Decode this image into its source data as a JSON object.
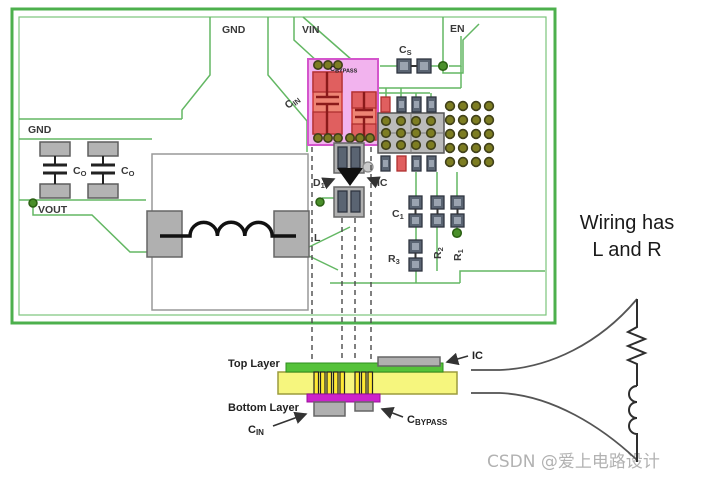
{
  "diagram": {
    "net_labels": {
      "gnd_top": {
        "main": "GND",
        "sub": ""
      },
      "vin": {
        "main": "VIN",
        "sub": ""
      },
      "en": {
        "main": "EN",
        "sub": ""
      },
      "gnd_left": {
        "main": "GND",
        "sub": ""
      },
      "vout": {
        "main": "VOUT",
        "sub": ""
      }
    },
    "components": {
      "cs": {
        "main": "C",
        "sub": "S"
      },
      "cin": {
        "main": "C",
        "sub": "IN"
      },
      "cbypass": {
        "main": "C",
        "sub": "BYPASS"
      },
      "co1": {
        "main": "C",
        "sub": "O"
      },
      "co2": {
        "main": "C",
        "sub": "O"
      },
      "l": {
        "main": "L",
        "sub": ""
      },
      "d1": {
        "main": "D",
        "sub": "1"
      },
      "ic": {
        "main": "IC",
        "sub": ""
      },
      "c1": {
        "main": "C",
        "sub": "1"
      },
      "r1": {
        "main": "R",
        "sub": "1"
      },
      "r2": {
        "main": "R",
        "sub": "2"
      },
      "r3": {
        "main": "R",
        "sub": "3"
      }
    },
    "cross_section": {
      "top_layer": "Top Layer",
      "bottom_layer": "Bottom Layer",
      "cin": {
        "main": "C",
        "sub": "IN"
      },
      "cbypass": {
        "main": "C",
        "sub": "BYPASS"
      },
      "ic": "IC"
    },
    "annotation": {
      "line1": "Wiring has",
      "line2": "L and R"
    },
    "watermark": "CSDN @爱上电路设计",
    "colors": {
      "board_outline": "#4db04d",
      "trace_green": "#63b763",
      "pink_region": "#f2b3ee",
      "cap_red": "#ee8474",
      "cap_red_pad": "#e05f5f",
      "via_olive": "#7d7d22",
      "via_green": "#4a8f2a",
      "pcb_yellow": "#f6f67e",
      "top_layer_green": "#55c23a",
      "bottom_layer_magenta": "#cc22cc",
      "ic_gray": "#bbbbbb",
      "pad_gray": "#b3b3b3"
    }
  }
}
